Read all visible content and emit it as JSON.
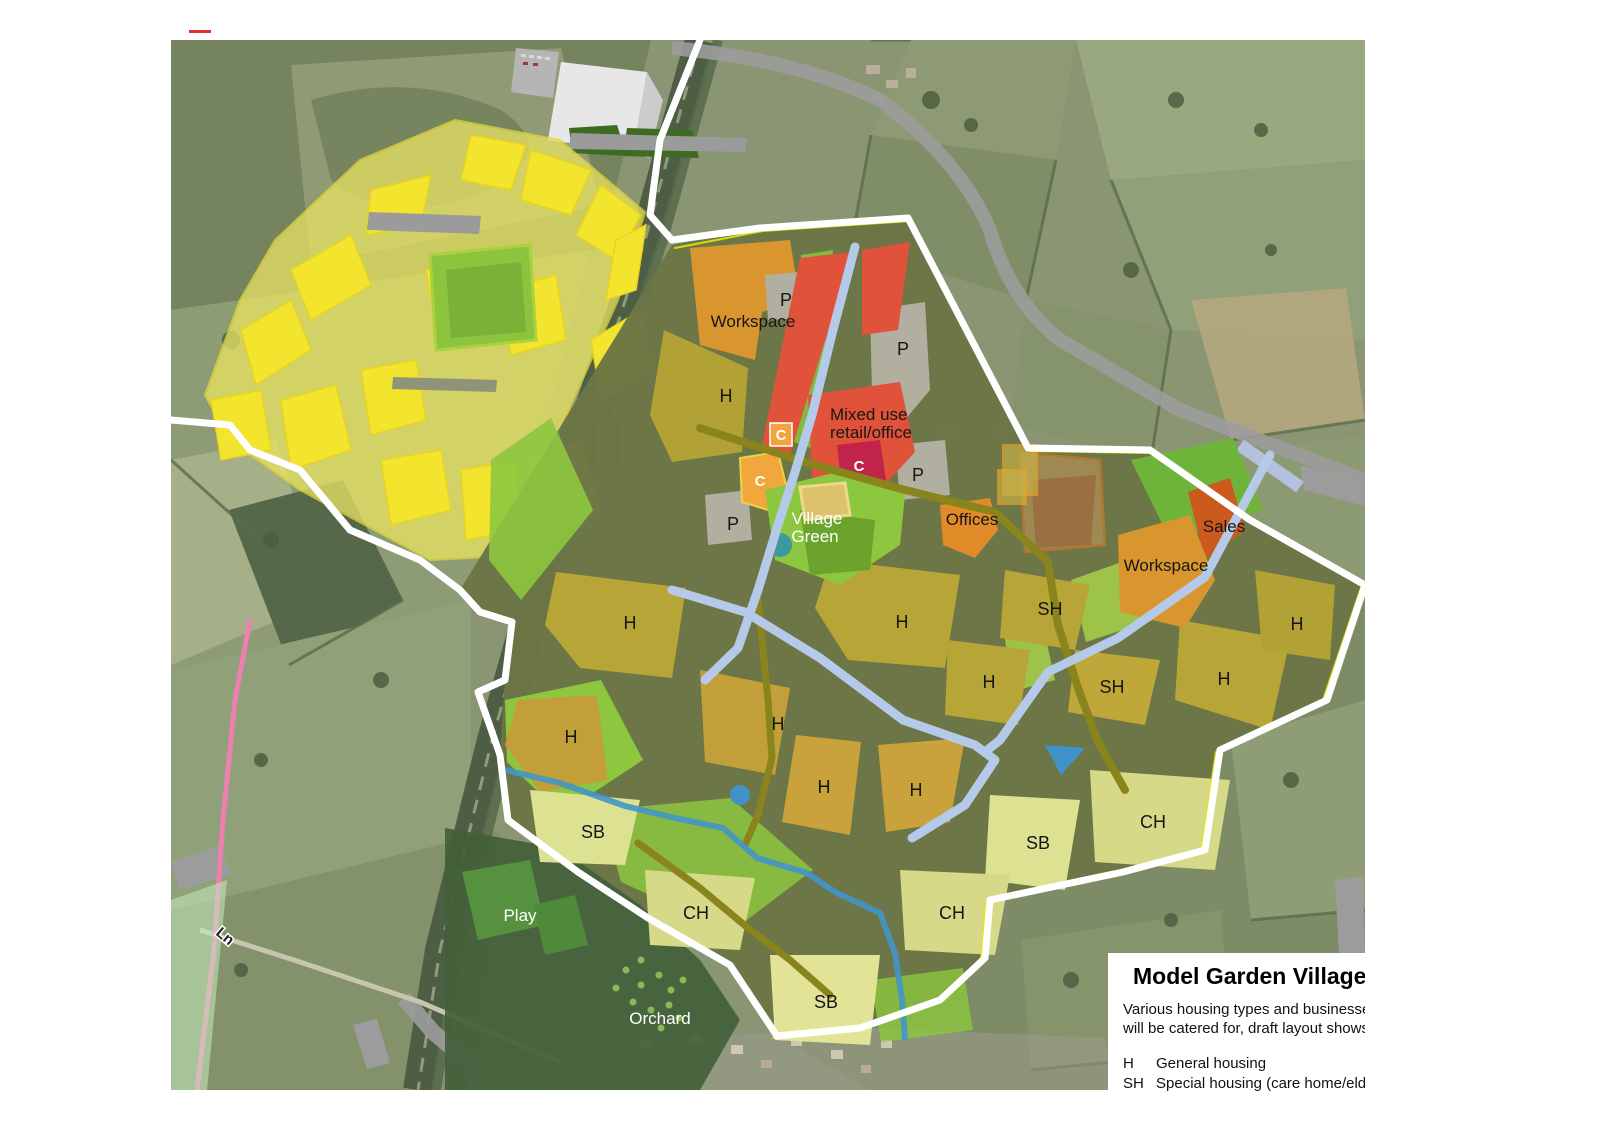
{
  "legend": {
    "title": "Model Garden Village",
    "line1": "Various housing types and businesses",
    "line2": "will be catered for, draft layout shows;",
    "entries": [
      {
        "code": "H",
        "label": "General housing"
      },
      {
        "code": "SH",
        "label": "Special housing (care home/elderl"
      }
    ]
  },
  "labels": [
    {
      "text": "P"
    },
    {
      "text": "Workspace"
    },
    {
      "text": "H"
    },
    {
      "text": "P"
    },
    {
      "text": "Mixed use"
    },
    {
      "text": "retail/office"
    },
    {
      "text": "C"
    },
    {
      "text": "C"
    },
    {
      "text": "C"
    },
    {
      "text": "P"
    },
    {
      "text": "Village"
    },
    {
      "text": "Green"
    },
    {
      "text": "P"
    },
    {
      "text": "Offices"
    },
    {
      "text": "Sales"
    },
    {
      "text": "Workspace"
    },
    {
      "text": "SH"
    },
    {
      "text": "H"
    },
    {
      "text": "H"
    },
    {
      "text": "H"
    },
    {
      "text": "H"
    },
    {
      "text": "SH"
    },
    {
      "text": "H"
    },
    {
      "text": "H"
    },
    {
      "text": "H"
    },
    {
      "text": "H"
    },
    {
      "text": "H"
    },
    {
      "text": "CH"
    },
    {
      "text": "SB"
    },
    {
      "text": "SB"
    },
    {
      "text": "CH"
    },
    {
      "text": "CH"
    },
    {
      "text": "SB"
    },
    {
      "text": "Play"
    },
    {
      "text": "Orchard"
    },
    {
      "text": "Ln"
    }
  ],
  "palette": {
    "housing_olive": "#b2a135",
    "housing_gold": "#c9a23c",
    "pale_parcel_sb": "#dde293",
    "pale_parcel_ch": "#d6d988",
    "workspace_orange": "#d9962f",
    "offices_orange": "#e08a28",
    "sales_orange": "#cc5a1e",
    "mixed_use_red": "#e1523a",
    "c_crimson": "#c2234a",
    "c_orange": "#f2a73c",
    "parking_grey": "#b0afa0",
    "green_space": "#8dc63f",
    "street_blue": "#b5c9e9",
    "spine_road_olive": "#8a841c",
    "stream_blue": "#4296c8",
    "boundary_white": "#ffffff",
    "boundary_yellow": "#e8e800",
    "existing_plan_yellow": "#f3e52e",
    "pink_route": "#ee7fb0"
  }
}
